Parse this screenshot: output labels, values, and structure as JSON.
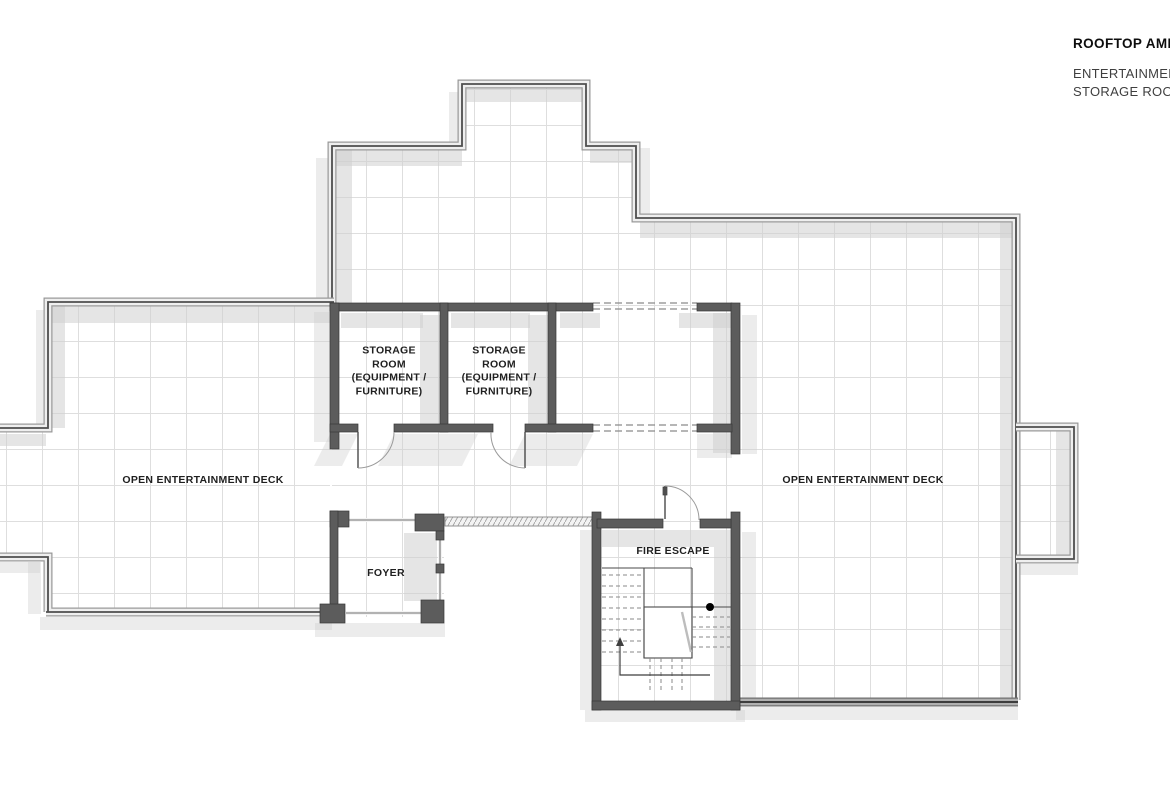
{
  "title_block": {
    "title": "ROOFTOP AMEN",
    "line1": "ENTERTAINMENT",
    "line2": "STORAGE ROOM"
  },
  "labels": {
    "storage_room_1": "STORAGE\nROOM\n(EQUIPMENT /\nFURNITURE)",
    "storage_room_2": "STORAGE\nROOM\n(EQUIPMENT /\nFURNITURE)",
    "open_deck_left": "OPEN ENTERTAINMENT DECK",
    "open_deck_right": "OPEN ENTERTAINMENT DECK",
    "foyer": "FOYER",
    "fire_escape": "FIRE ESCAPE"
  },
  "colors": {
    "wall": "#5c5c5c",
    "parapet_band": "#efefef",
    "parapet_edge": "#9a9a9a",
    "shadow": "#cfcfcf",
    "grid": "#dedede",
    "title": "#0d0d0d",
    "subtitle": "#3f3f3f",
    "label": "#1f1f1f"
  }
}
